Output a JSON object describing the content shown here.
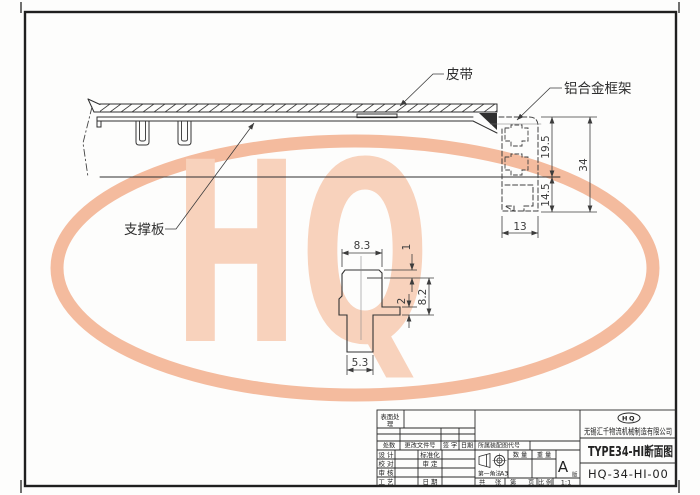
{
  "drawing": {
    "labels": {
      "belt": "皮带",
      "frame": "铝合金框架",
      "support_plate": "支撑板"
    },
    "dims": {
      "h_upper": "19.5",
      "h_total": "34",
      "h_lower": "14.5",
      "w_frame": "13",
      "det_top_width": "8.3",
      "det_step": "1",
      "det_right_height": "8.2",
      "det_lip": "2",
      "det_stem_width": "5.3"
    }
  },
  "watermark": {
    "text": "HQ"
  },
  "colors": {
    "watermark_ring": "#f4bb9e",
    "watermark_text": "#f8d2bc",
    "line": "#343434"
  },
  "title_block": {
    "surface_label_line1": "表面处",
    "surface_label_line2": "理",
    "rev_header": {
      "count": "处数",
      "doc_no": "更改文件号",
      "sign": "签 字",
      "date": "日期"
    },
    "sign_rows": [
      {
        "left": "设 计",
        "right": "标准化"
      },
      {
        "left": "校 对",
        "right": "审 定"
      },
      {
        "left": "审 核",
        "right": ""
      },
      {
        "left": "工 艺",
        "right": "日 期"
      }
    ],
    "assembly_code_label": "所属装配图代号",
    "projection_label": "第一角法",
    "sheet_size": "A3",
    "qty_label": "数 量",
    "weight_label": "重 量",
    "version_letter": "A",
    "version_label": "版",
    "footer": {
      "total": "共",
      "sheets": "张",
      "no": "第",
      "page": "页",
      "scale_label": "比 例",
      "scale": "1:1"
    },
    "logo": "HQ",
    "company": "无锡汇千物流机械制造有限公司",
    "title": "TYPE34-HI断面图",
    "number": "HQ-34-HI-00"
  }
}
